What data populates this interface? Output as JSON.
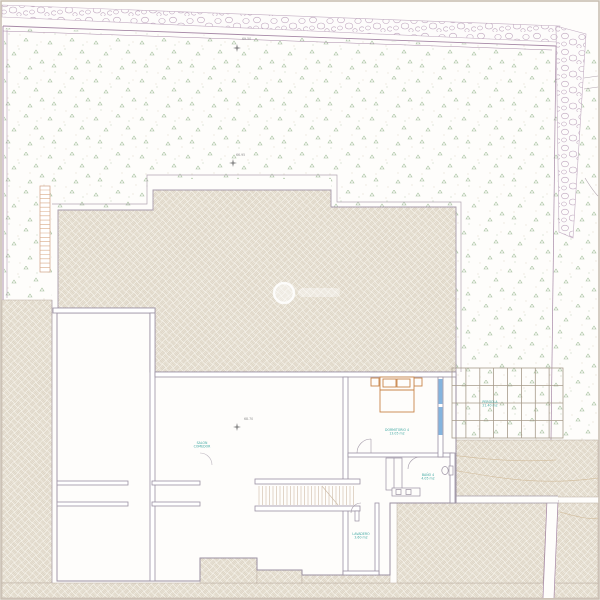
{
  "drawing": {
    "kind": "architectural-site-plan",
    "labels": {
      "elev_top": "69.50",
      "elev_mid": "66.95",
      "elev_salon": "68.70",
      "salon_l1": "SALON",
      "salon_l2": "COMEDOR",
      "dorm_l1": "DORMITORIO 4",
      "dorm_l2": "13.05 m2",
      "pergola_l1": "PERGOLA",
      "pergola_l2": "21.40 m2",
      "bano_l1": "BAÑO 4",
      "bano_l2": "4.05 m2",
      "lav_l1": "LAVADERO",
      "lav_l2": "3.60 m2"
    },
    "colors": {
      "paper": "#fefdfb",
      "hatch_line": "#d5cbb9",
      "hatch_bg": "#f3efe6",
      "stone_line": "#bda4bd",
      "boundary_purple": "#a688a6",
      "wall_line": "#9a90a2",
      "teal_text": "#3fa8a2",
      "elev_text": "#8f8f8f",
      "bed_orange": "#c8854a",
      "window_blue": "#6ea7d8",
      "plant_green": "#9dbb95"
    }
  }
}
